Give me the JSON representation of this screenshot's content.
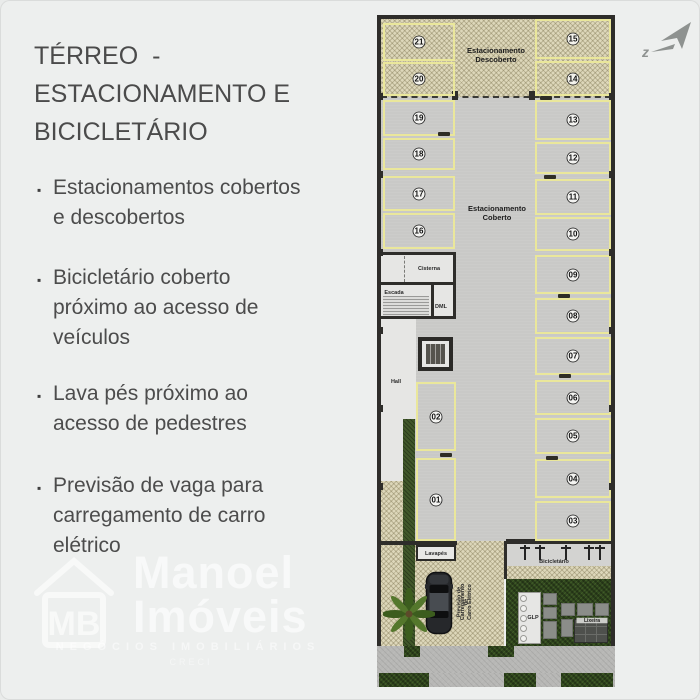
{
  "slide": {
    "title_lines": [
      "TÉRREO  -",
      "ESTACIONAMENTO E",
      "BICICLETÁRIO"
    ],
    "bullets": [
      {
        "lines": [
          "Estacionamentos cobertos",
          "e descobertos"
        ]
      },
      {
        "lines": [
          "Bicicletário coberto",
          "próximo ao acesso de",
          "veículos"
        ]
      },
      {
        "lines": [
          "Lava pés próximo ao",
          "acesso de pedestres"
        ]
      },
      {
        "lines": [
          "Previsão de vaga para",
          "carregamento de carro",
          "elétrico"
        ]
      }
    ]
  },
  "watermark": {
    "logo_initials": "MB",
    "name_line1": "Manoel",
    "name_line2": "Imóveis",
    "tagline": "NEGÓCIOS IMOBILIÁRIOS",
    "creci": "CRECI"
  },
  "compass": {
    "label": "z"
  },
  "colors": {
    "background": "#edefee",
    "text": "#4c4c4c",
    "parking_line_yellow": "#eae79b",
    "concrete": "#c9c9c7",
    "uncovered_hatch": "#ddd7ba",
    "garden_green": "#31471f",
    "wall": "#2e2d2a"
  },
  "plan": {
    "labels": {
      "descoberto_l1": "Estacionamento",
      "descoberto_l2": "Descoberto",
      "coberto_l1": "Estacionamento",
      "coberto_l2": "Coberto",
      "cisterna": "Cisterna",
      "escada": "Escada",
      "dml": "DML",
      "hall": "Hall",
      "lavapes": "Lavapés",
      "bicicletario": "Bicicletário",
      "glp": "GLP",
      "lixeira": "Lixeira",
      "ev_l1": "Previsão de",
      "ev_l2": "Carregamento de",
      "ev_l3": "Carro Elétrico"
    },
    "spots": [
      {
        "num": "21",
        "x": 6,
        "y": 8,
        "w": 72,
        "h": 38,
        "zone": "open"
      },
      {
        "num": "20",
        "x": 6,
        "y": 47,
        "w": 72,
        "h": 34,
        "zone": "open"
      },
      {
        "num": "19",
        "x": 6,
        "y": 85,
        "w": 72,
        "h": 36,
        "zone": "covered"
      },
      {
        "num": "18",
        "x": 6,
        "y": 123,
        "w": 72,
        "h": 32,
        "zone": "covered"
      },
      {
        "num": "17",
        "x": 6,
        "y": 161,
        "w": 72,
        "h": 35,
        "zone": "covered"
      },
      {
        "num": "16",
        "x": 6,
        "y": 198,
        "w": 72,
        "h": 36,
        "zone": "covered"
      },
      {
        "num": "15",
        "x": 158,
        "y": 4,
        "w": 76,
        "h": 40,
        "zone": "open"
      },
      {
        "num": "14",
        "x": 158,
        "y": 46,
        "w": 76,
        "h": 35,
        "zone": "open"
      },
      {
        "num": "13",
        "x": 158,
        "y": 85,
        "w": 76,
        "h": 40,
        "zone": "covered"
      },
      {
        "num": "12",
        "x": 158,
        "y": 127,
        "w": 76,
        "h": 32,
        "zone": "covered"
      },
      {
        "num": "11",
        "x": 158,
        "y": 164,
        "w": 76,
        "h": 36,
        "zone": "covered"
      },
      {
        "num": "10",
        "x": 158,
        "y": 202,
        "w": 76,
        "h": 34,
        "zone": "covered"
      },
      {
        "num": "09",
        "x": 158,
        "y": 240,
        "w": 76,
        "h": 39,
        "zone": "covered"
      },
      {
        "num": "08",
        "x": 158,
        "y": 283,
        "w": 76,
        "h": 36,
        "zone": "covered"
      },
      {
        "num": "07",
        "x": 158,
        "y": 322,
        "w": 76,
        "h": 38,
        "zone": "covered"
      },
      {
        "num": "06",
        "x": 158,
        "y": 365,
        "w": 76,
        "h": 35,
        "zone": "covered"
      },
      {
        "num": "05",
        "x": 158,
        "y": 403,
        "w": 76,
        "h": 36,
        "zone": "covered"
      },
      {
        "num": "04",
        "x": 158,
        "y": 444,
        "w": 76,
        "h": 39,
        "zone": "covered"
      },
      {
        "num": "03",
        "x": 158,
        "y": 486,
        "w": 76,
        "h": 40,
        "zone": "covered"
      },
      {
        "num": "02",
        "x": 39,
        "y": 367,
        "w": 40,
        "h": 69,
        "zone": "covered"
      },
      {
        "num": "01",
        "x": 39,
        "y": 443,
        "w": 40,
        "h": 83,
        "zone": "covered"
      }
    ],
    "wheel_stops": [
      [
        67,
        119
      ],
      [
        169,
        83
      ],
      [
        173,
        162
      ],
      [
        187,
        281
      ],
      [
        188,
        361
      ],
      [
        175,
        443
      ],
      [
        69,
        440
      ]
    ],
    "pillars": [
      [
        1,
        78
      ],
      [
        1,
        156
      ],
      [
        1,
        234
      ],
      [
        1,
        312
      ],
      [
        1,
        390
      ],
      [
        1,
        468
      ],
      [
        232,
        78
      ],
      [
        232,
        156
      ],
      [
        232,
        234
      ],
      [
        232,
        312
      ],
      [
        232,
        390
      ],
      [
        232,
        468
      ]
    ]
  }
}
